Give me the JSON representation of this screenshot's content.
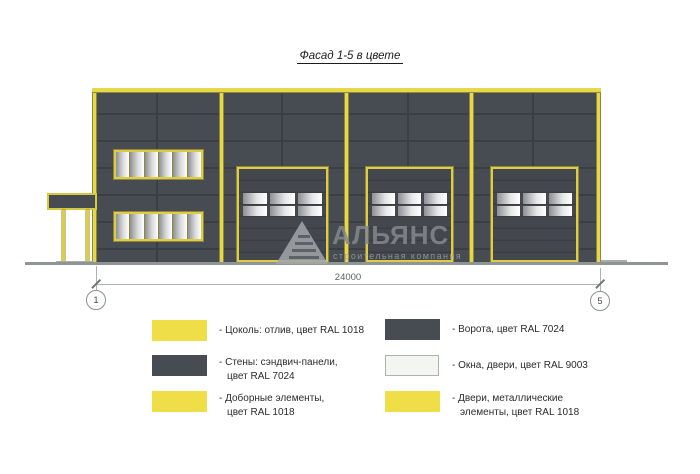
{
  "title": "Фасад 1-5 в цвете",
  "dimension": {
    "value": "24000",
    "axis_start": "1",
    "axis_end": "5"
  },
  "watermark": {
    "name": "АЛЬЯНС",
    "subtitle": "строительная компания"
  },
  "colors": {
    "walls_ral_7024": "#474b52",
    "trim_ral_1018": "#e7d74b",
    "glass_ral_9003": "#f2f5f0",
    "panel_joint": "#3b3f45",
    "legend_yellow": "#f0de48",
    "legend_dark": "#474b52",
    "legend_white": "#f2f5f0",
    "ground_gray": "#8f9595"
  },
  "legend": {
    "items": [
      {
        "color": "#f0de48",
        "lines": [
          "- Цоколь: отлив, цвет RAL 1018",
          ""
        ]
      },
      {
        "color": "#474b52",
        "lines": [
          "- Стены: сэндвич-панели,",
          "цвет RAL 7024"
        ]
      },
      {
        "color": "#f0de48",
        "lines": [
          "- Доборные элементы,",
          "цвет RAL 1018"
        ]
      },
      {
        "color": "#474b52",
        "lines": [
          "- Ворота, цвет RAL 7024",
          ""
        ]
      },
      {
        "color": "#f2f5f0",
        "lines": [
          "- Окна, двери, цвет RAL 9003",
          ""
        ]
      },
      {
        "color": "#f0de48",
        "lines": [
          "- Двери, металлические",
          "элементы, цвет RAL 1018"
        ]
      }
    ]
  }
}
